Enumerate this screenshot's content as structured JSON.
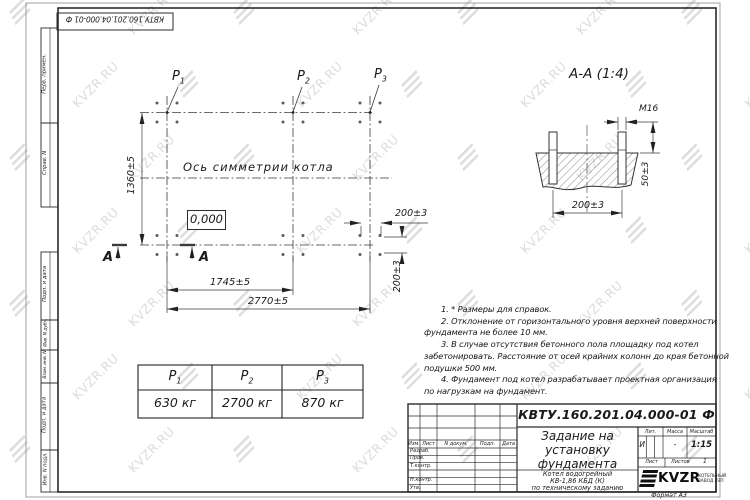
{
  "watermark": {
    "text": "KVZR.RU"
  },
  "stamp": {
    "doc_number": "КВТУ.160.201.04.000-01 Ф"
  },
  "margin": {
    "cells": [
      "Перв. примен.",
      "Справ. N",
      "Подп. и дата",
      "Инв. N дубл.",
      "Взам. инв. N",
      "Подп. и дата",
      "Инв. N подл."
    ]
  },
  "plan": {
    "points": [
      {
        "base": "P",
        "sub": "1"
      },
      {
        "base": "P",
        "sub": "2"
      },
      {
        "base": "P",
        "sub": "3"
      }
    ],
    "axis_label": "Ось симметрии котла",
    "elevation": "0,000",
    "dim_width": "1360±5",
    "dim_1745": "1745±5",
    "dim_2770": "2770±5",
    "dim_200_h": "200±3",
    "dim_200_v": "200±3",
    "section_letter": "А"
  },
  "section": {
    "title": "А-А (1:4)",
    "bolt_thread": "M16",
    "dim_height": "50±3",
    "dim_spacing": "200±3"
  },
  "notes": {
    "lines": [
      "1. * Размеры для справок.",
      "2. Отклонение от горизонтального уровня верхней поверхности",
      "фундамента не более 10 мм.",
      "3. В случае отсутствия бетонного пола площадку под котел",
      "забетонировать. Расстояние от осей крайних колонн до края бетонной",
      "подушки 500 мм.",
      "4. Фундамент под котел разрабатывает проектная организация",
      "по нагрузкам на фундамент."
    ]
  },
  "load_table": {
    "headers": [
      {
        "base": "P",
        "sub": "1"
      },
      {
        "base": "P",
        "sub": "2"
      },
      {
        "base": "P",
        "sub": "3"
      }
    ],
    "values": [
      "630 кг",
      "2700 кг",
      "870 кг"
    ]
  },
  "title_block": {
    "doc_number": "КВТУ.160.201.04.000-01 Ф",
    "title_lines": [
      "Задание на",
      "установку",
      "фундамента"
    ],
    "product_lines": [
      "Котел водогрейный",
      "КВ-1,86 КБД (К)",
      "по техническому заданию"
    ],
    "cols": {
      "izm": "Изм.",
      "list": "Лист",
      "doc": "N докум.",
      "podp": "Подп.",
      "data": "Дата"
    },
    "rows": [
      "Разраб.",
      "Пров.",
      "Т.контр.",
      "",
      "Н.контр.",
      "Утв."
    ],
    "lit_label": "Лит.",
    "lit_value": "И",
    "mass_label": "Масса",
    "mass_value": "-",
    "scale_label": "Масштаб",
    "scale_value": "1:15",
    "sheet_label": "Лист",
    "sheets_label": "Листов",
    "sheets_value": "1",
    "logo_text": "KVZR",
    "logo_caption_lines": [
      "КОТЕЛЬНЫЙ",
      "ЗАВОД РЭП"
    ],
    "format": "Формат А3"
  }
}
